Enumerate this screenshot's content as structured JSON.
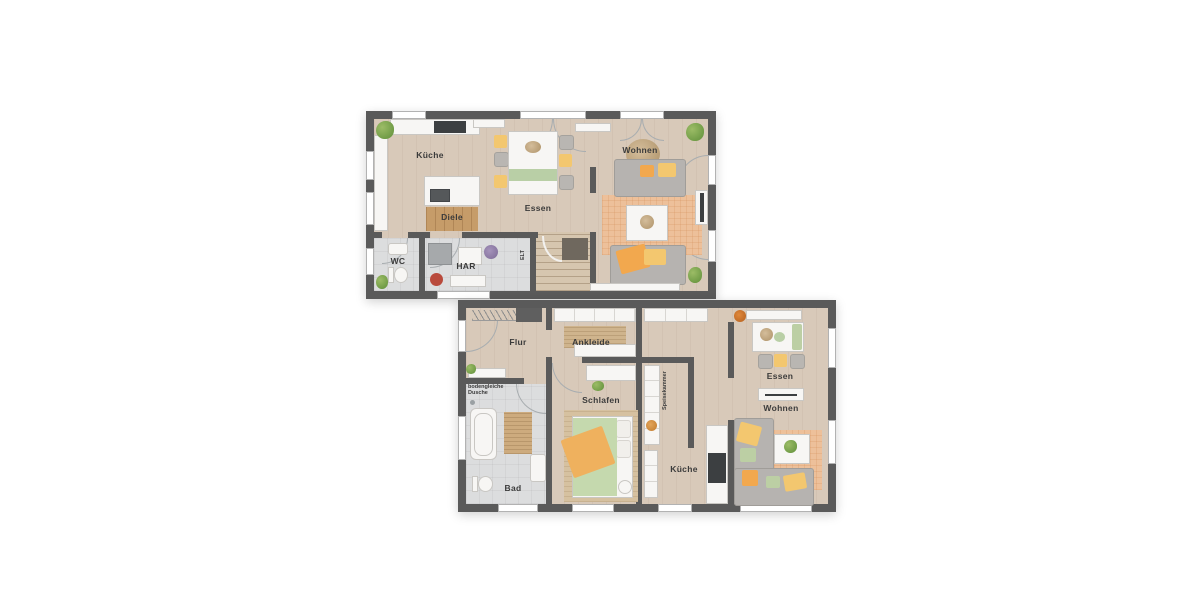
{
  "palette": {
    "wall": "#5a5a5a",
    "floor_wood": "#d8c9b9",
    "floor_tile": "#dcddde",
    "rug_terracotta": "#edc09a",
    "rug_jute": "#cfb48d",
    "furniture_white": "#f7f6f4",
    "sofa_gray": "#b6b3b0",
    "accent_orange": "#f2a84e",
    "accent_yellow": "#f3c76f",
    "accent_green": "#bccfa4",
    "plant_green": "#6f9e45"
  },
  "plans": {
    "upper_floor": {
      "rooms": {
        "kueche": {
          "label": "Küche"
        },
        "diele": {
          "label": "Diele"
        },
        "essen": {
          "label": "Essen"
        },
        "wohnen": {
          "label": "Wohnen"
        },
        "wc": {
          "label": "WC"
        },
        "har": {
          "label": "HAR"
        },
        "elt": {
          "label": "ELT"
        }
      }
    },
    "lower_floor": {
      "rooms": {
        "flur": {
          "label": "Flur"
        },
        "ankleide": {
          "label": "Ankleide"
        },
        "dusche_note": {
          "label": "bodengleiche Dusche"
        },
        "bad": {
          "label": "Bad"
        },
        "schlafen": {
          "label": "Schlafen"
        },
        "speisekammer": {
          "label": "Speisekammer"
        },
        "kueche": {
          "label": "Küche"
        },
        "essen": {
          "label": "Essen"
        },
        "wohnen": {
          "label": "Wohnen"
        }
      }
    }
  }
}
